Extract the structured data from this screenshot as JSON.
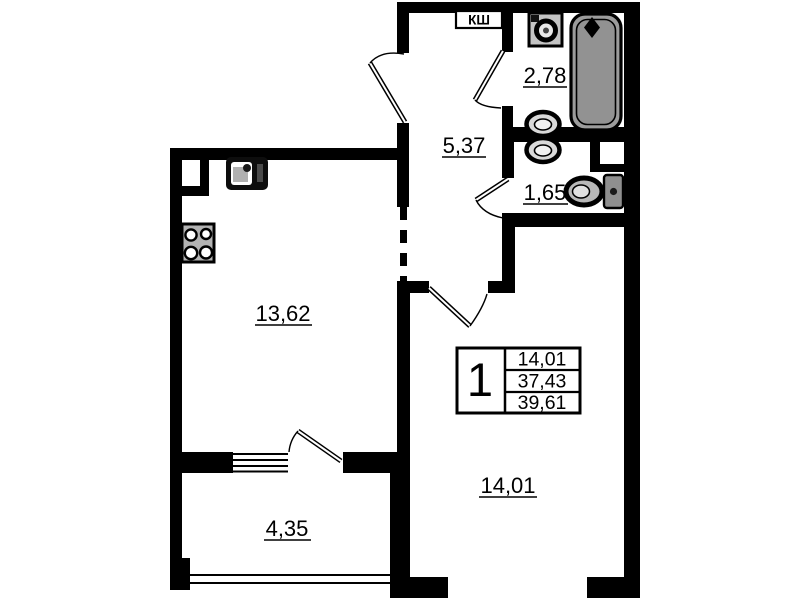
{
  "plan": {
    "type": "apartment-floor-plan",
    "duct_label": "КШ",
    "rooms": [
      {
        "id": "hallway",
        "area": "5,37"
      },
      {
        "id": "bathroom",
        "area": "2,78"
      },
      {
        "id": "wc",
        "area": "1,65"
      },
      {
        "id": "kitchen-living",
        "area": "13,62"
      },
      {
        "id": "room",
        "area": "14,01"
      },
      {
        "id": "balcony",
        "area": "4,35"
      }
    ],
    "unit_table": {
      "rooms_count": "1",
      "values": [
        "14,01",
        "37,43",
        "39,61"
      ]
    },
    "icons": [
      "bathtub-icon",
      "washing-machine-icon",
      "sink-icon",
      "toilet-icon",
      "kitchen-sink-icon",
      "stove-icon",
      "duct-shaft"
    ],
    "colors": {
      "wall": "#000000",
      "background": "#ffffff",
      "bathtub_fill": "#9c9c9c",
      "fixture_gray": "#b5b5b5"
    }
  }
}
